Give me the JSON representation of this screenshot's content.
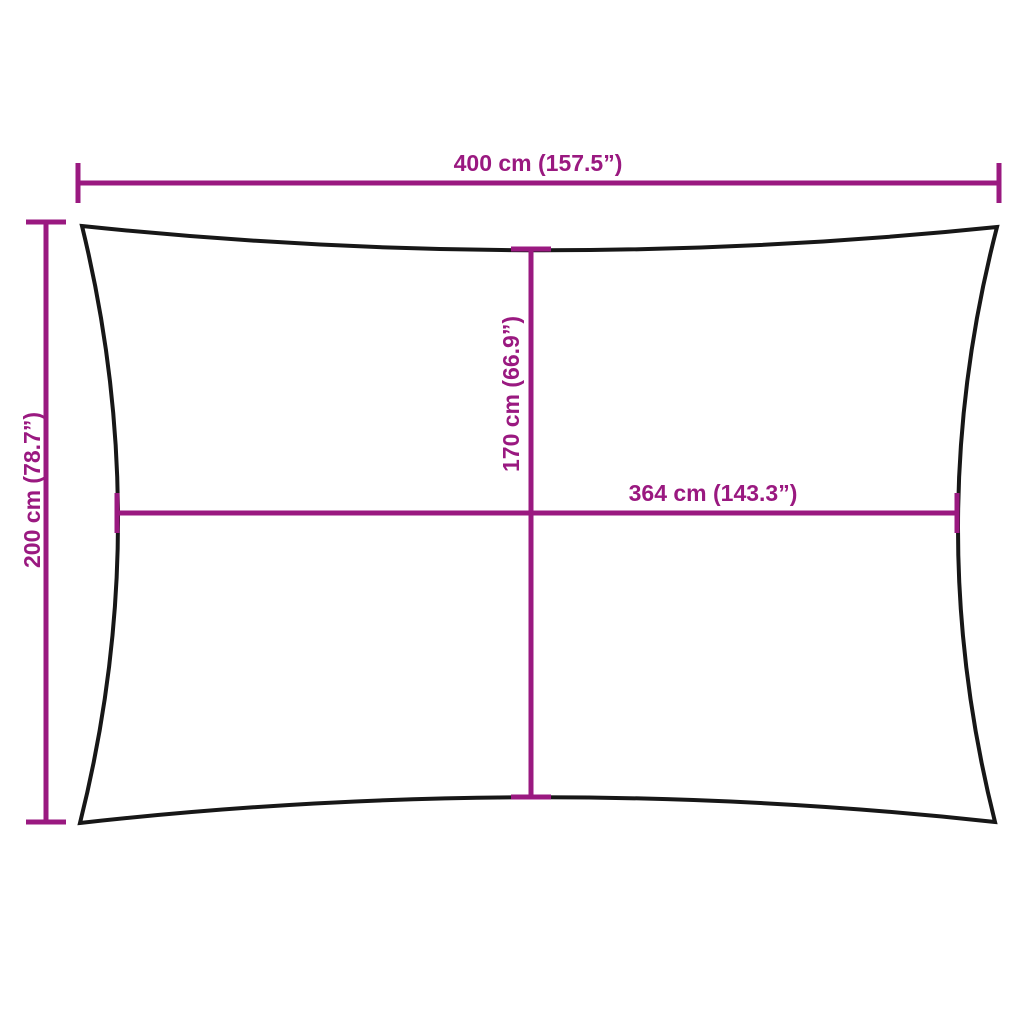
{
  "diagram": {
    "kind": "shade-sail-dimension-diagram",
    "shape": "rectangle-concave-edges"
  },
  "measurements": {
    "top_width": {
      "label": "400 cm (157.5”)",
      "cm": "400",
      "inches": "157.5"
    },
    "left_height": {
      "label": "200 cm (78.7”)",
      "cm": "200",
      "inches": "78.7"
    },
    "center_height": {
      "label": "170 cm (66.9”)",
      "cm": "170",
      "inches": "66.9"
    },
    "center_width": {
      "label": "364 cm (143.3”)",
      "cm": "364",
      "inches": "143.3"
    }
  },
  "colors": {
    "dimension": "#9A1980",
    "outline": "#171717",
    "background": "#FFFFFF"
  }
}
